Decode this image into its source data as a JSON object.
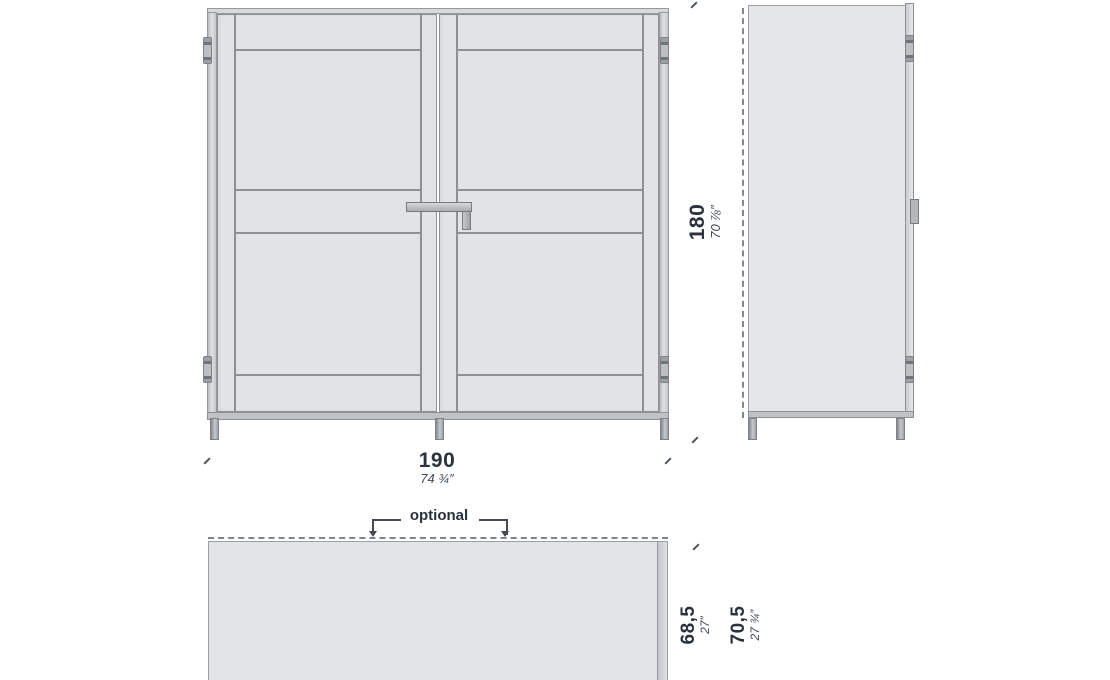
{
  "diagram": {
    "type": "furniture-dimension-drawing",
    "annotations": {
      "optional_label": "optional"
    },
    "dimensions": {
      "width_cm": "190",
      "width_in": "74 ¾″",
      "height_cm": "180",
      "height_in": "70 ⅞″",
      "depth_cm": "68,5",
      "depth_in": "27″",
      "depth_total_cm": "70,5",
      "depth_total_in": "27 ¾″"
    },
    "colors": {
      "body_fill": "#e2e3e5",
      "outline": "#8d9196",
      "text": "#2a323e"
    }
  }
}
